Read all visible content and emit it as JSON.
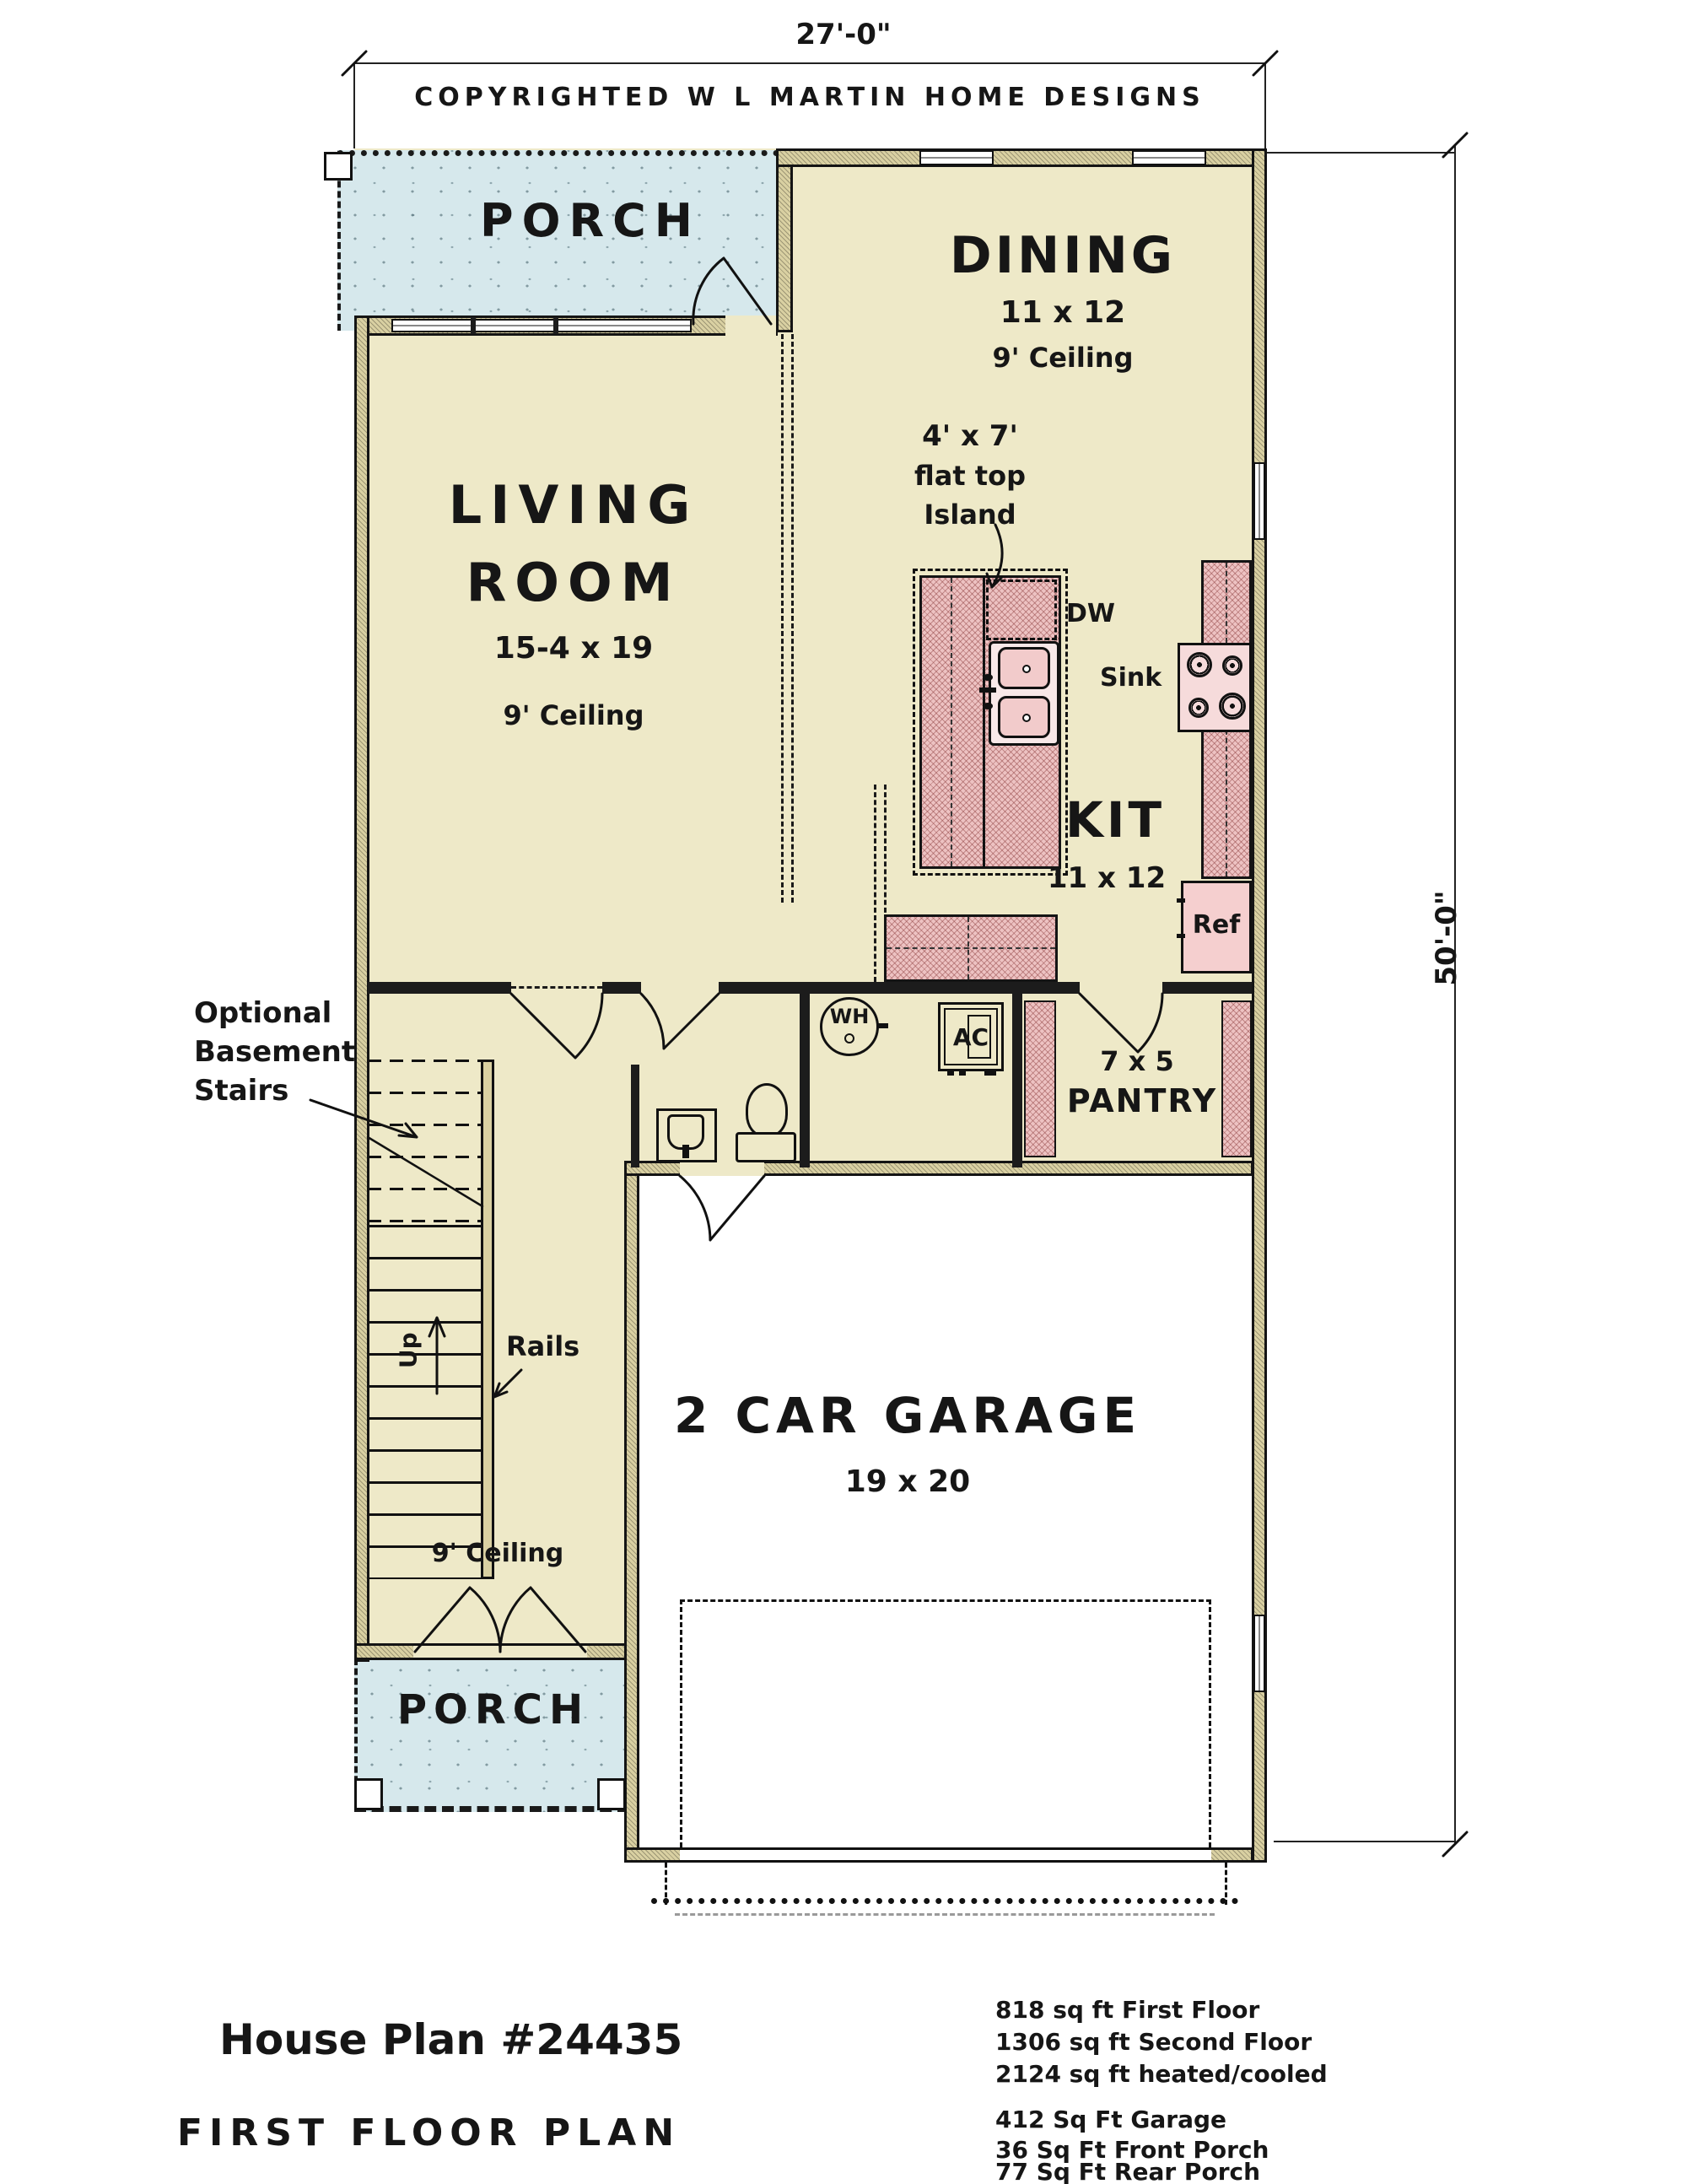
{
  "dimensions": {
    "width": "27'-0\"",
    "height": "50'-0\""
  },
  "copyright": "COPYRIGHTED W L MARTIN HOME DESIGNS",
  "front_porch": {
    "label": "PORCH"
  },
  "dining": {
    "name": "DINING",
    "size": "11 x 12",
    "ceiling": "9' Ceiling"
  },
  "living": {
    "name1": "LIVING",
    "name2": "ROOM",
    "size": "15-4 x 19",
    "ceiling": "9' Ceiling"
  },
  "kitchen": {
    "name": "KIT",
    "size": "11 x 12",
    "dw": "DW",
    "sink": "Sink",
    "ref": "Ref",
    "island_note1": "4' x 7'",
    "island_note2": "flat top",
    "island_note3": "Island"
  },
  "utility": {
    "wh": "WH",
    "ac": "AC"
  },
  "pantry": {
    "size": "7 x 5",
    "name": "PANTRY"
  },
  "stairs": {
    "note1": "Optional",
    "note2": "Basement",
    "note3": "Stairs",
    "up": "Up",
    "rails": "Rails"
  },
  "hall": {
    "ceiling": "9' Ceiling"
  },
  "garage": {
    "name": "2 CAR GARAGE",
    "size": "19 x 20"
  },
  "rear_porch": {
    "label": "PORCH"
  },
  "footer": {
    "plan": "House Plan #24435",
    "sheet": "FIRST FLOOR PLAN",
    "areas_main": [
      "818 sq ft First Floor",
      "1306 sq ft Second Floor",
      "2124 sq ft heated/cooled"
    ],
    "areas_other": [
      "412 Sq Ft Garage",
      "36 Sq Ft Front Porch",
      "77 Sq Ft Rear Porch"
    ]
  }
}
